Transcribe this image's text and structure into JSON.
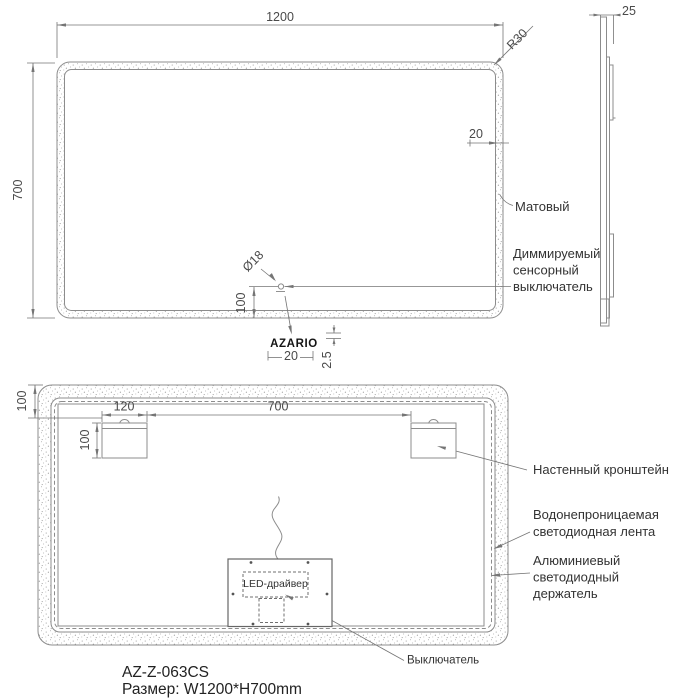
{
  "front_view": {
    "dim_width": "1200",
    "dim_height": "700",
    "corner_radius": "R30",
    "dim_frame_width": "20",
    "label_matte": "Матовый",
    "switch_diameter": "Ø18",
    "dim_switch_offset": "100",
    "label_touch_switch_line1": "Диммируемый",
    "label_touch_switch_line2": "сенсорный",
    "label_touch_switch_line3": "выключатель",
    "logo_text": "AZARIO",
    "dim_logo_width": "20",
    "dim_logo_height": "2.5"
  },
  "side_view": {
    "dim_thickness": "25"
  },
  "rear_view": {
    "dim_top_offset": "100",
    "dim_bracket_width": "120",
    "dim_bracket_spacing": "700",
    "dim_bracket_height": "100",
    "label_wall_bracket": "Настенный кронштейн",
    "label_led_strip_line1": "Водонепроницаемая",
    "label_led_strip_line2": "светодиодная лента",
    "label_led_holder_line1": "Алюминиевый",
    "label_led_holder_line2": "светодиодный",
    "label_led_holder_line3": "держатель",
    "label_led_driver": "LED-драйвер",
    "label_switch": "Выключатель"
  },
  "title_block": {
    "model": "AZ-Z-063CS",
    "size": "Размер: W1200*H700mm"
  },
  "colors": {
    "line": "#8c8c8c",
    "dim_line": "#757575",
    "text": "#3d3d3d",
    "background": "#ffffff"
  }
}
